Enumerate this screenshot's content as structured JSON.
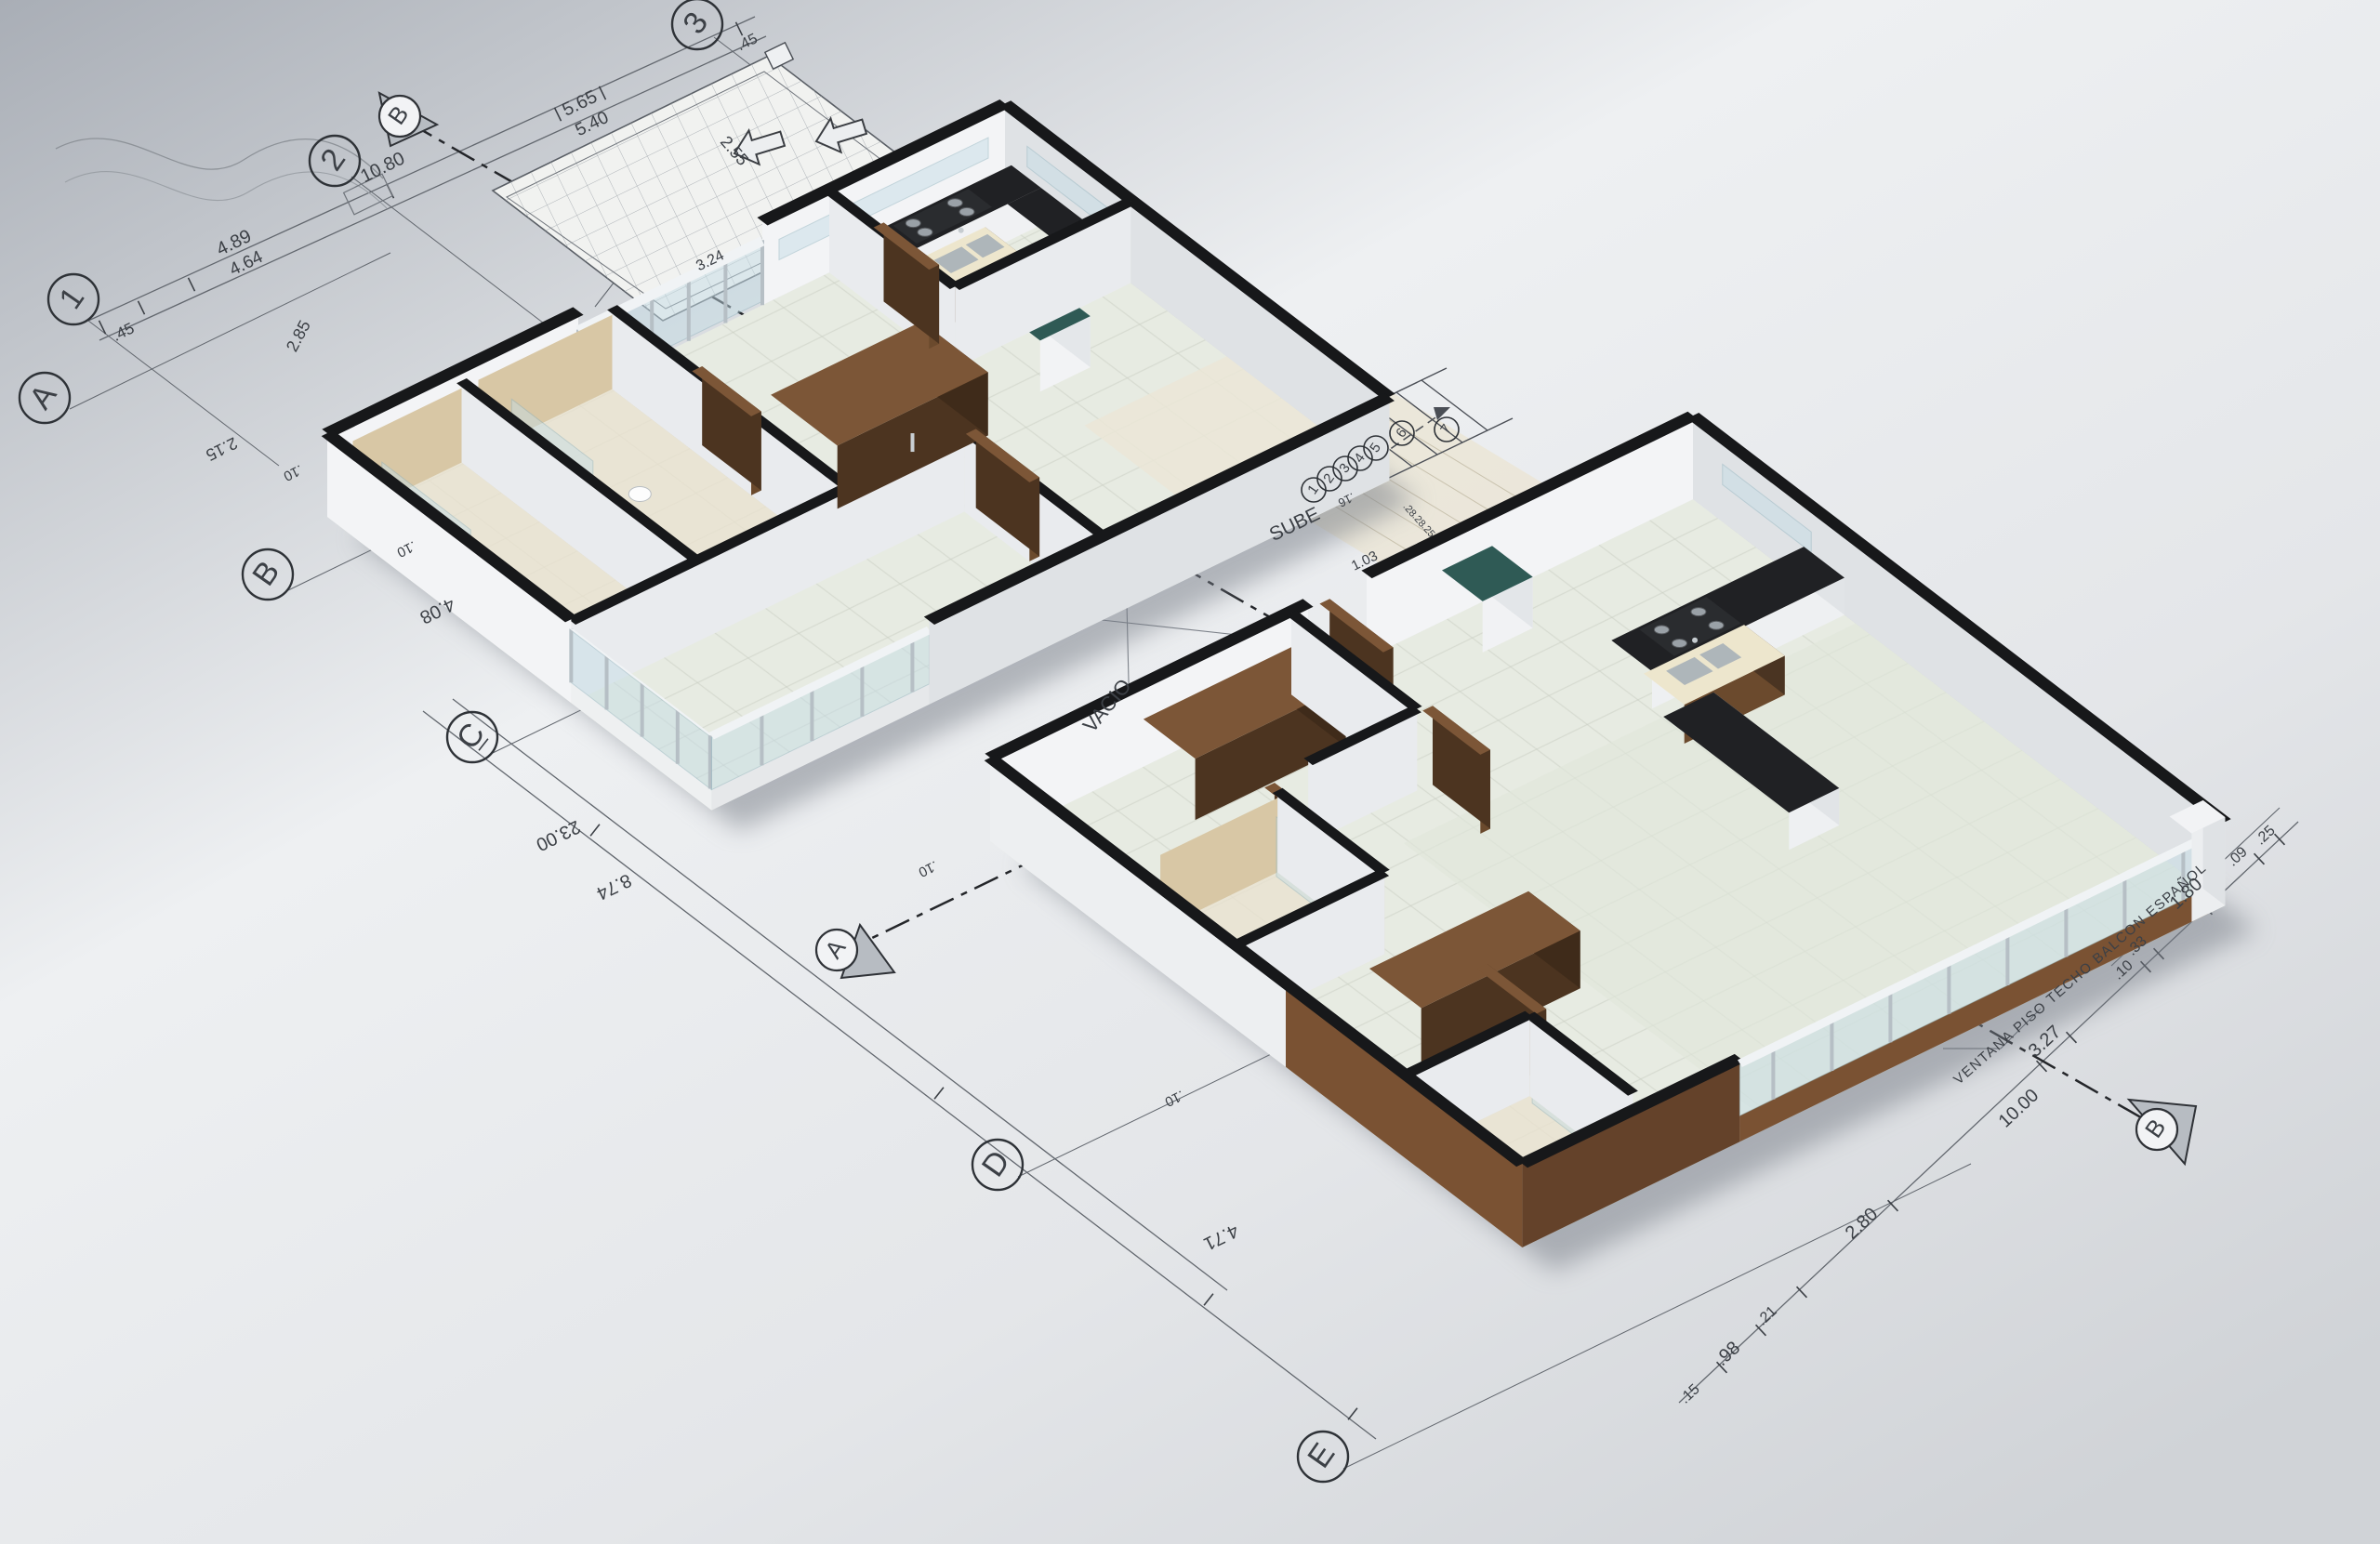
{
  "grid": {
    "columns": [
      "1",
      "2",
      "3"
    ],
    "rows": [
      "A",
      "B",
      "C",
      "D",
      "E"
    ]
  },
  "sections": {
    "top": "B",
    "middle": "A",
    "bottom": "B"
  },
  "stairs": {
    "label": "SUBE",
    "steps": [
      "1",
      "2",
      "3",
      "4",
      "5",
      "6",
      "7"
    ],
    "riser_dims": [
      ".28",
      ".28",
      ".25"
    ],
    "tread_dims": [
      ".16",
      "1.03"
    ]
  },
  "labels": {
    "void": "VACIO",
    "window_note": "VENTANA PISO TECHO BALCON ESPAÑOL"
  },
  "dims": [
    {
      "v": ".45"
    },
    {
      "v": "4.89"
    },
    {
      "v": "4.64"
    },
    {
      "v": "10.80"
    },
    {
      "v": "5.65"
    },
    {
      "v": "5.40"
    },
    {
      "v": ".45"
    },
    {
      "v": "2.55"
    },
    {
      "v": "2.85"
    },
    {
      "v": "2.15"
    },
    {
      "v": ".10"
    },
    {
      "v": "4.08"
    },
    {
      "v": "23.00"
    },
    {
      "v": "8.74"
    },
    {
      "v": ".10"
    },
    {
      "v": ".10"
    },
    {
      "v": "4.71"
    },
    {
      "v": "3.24"
    },
    {
      "v": ".25"
    },
    {
      "v": ".09"
    },
    {
      "v": "1.80"
    },
    {
      "v": ".33"
    },
    {
      "v": ".10"
    },
    {
      "v": "3.27"
    },
    {
      "v": "10.00"
    },
    {
      "v": "2.80"
    },
    {
      "v": ".21"
    },
    {
      "v": ".98"
    },
    {
      "v": ".15"
    },
    {
      "v": ".10"
    }
  ],
  "colors": {
    "paper_top": "#a9aeb6",
    "paper_mid": "#eef0f2",
    "paper_low": "#d6d8db",
    "ink": "#4a4e55",
    "ink_light": "#8d9298",
    "wall_light": "#f3f4f6",
    "wall_mid": "#e9ebee",
    "wall_shade": "#dfe2e5",
    "wall_dark": "#d3d6da",
    "cap": "#17181a",
    "floor": "#e7ebe2",
    "floor_big": "#e1e7da",
    "grout": "#c9cec3",
    "terrace": "#ebe6d7",
    "tan": "#d8c7a5",
    "tan_dark": "#c6b28a",
    "tan_floor": "#e9e2cf",
    "wood": "#6b4a2d",
    "wood_dark": "#4c3420",
    "wood_top": "#7c5637",
    "clad": "#7a5233",
    "clad_dark": "#64422a",
    "counter": "#202124",
    "cream": "#ede6cd",
    "stove": "#2a2c2f",
    "steel": "#aab3b8",
    "teal": "#2f5a55",
    "glass": "#c5dde6",
    "glass_edge": "#8fb3bf",
    "rail": "#f0f3f5",
    "post": "#b6bfc5",
    "shadow": "#767c85"
  }
}
